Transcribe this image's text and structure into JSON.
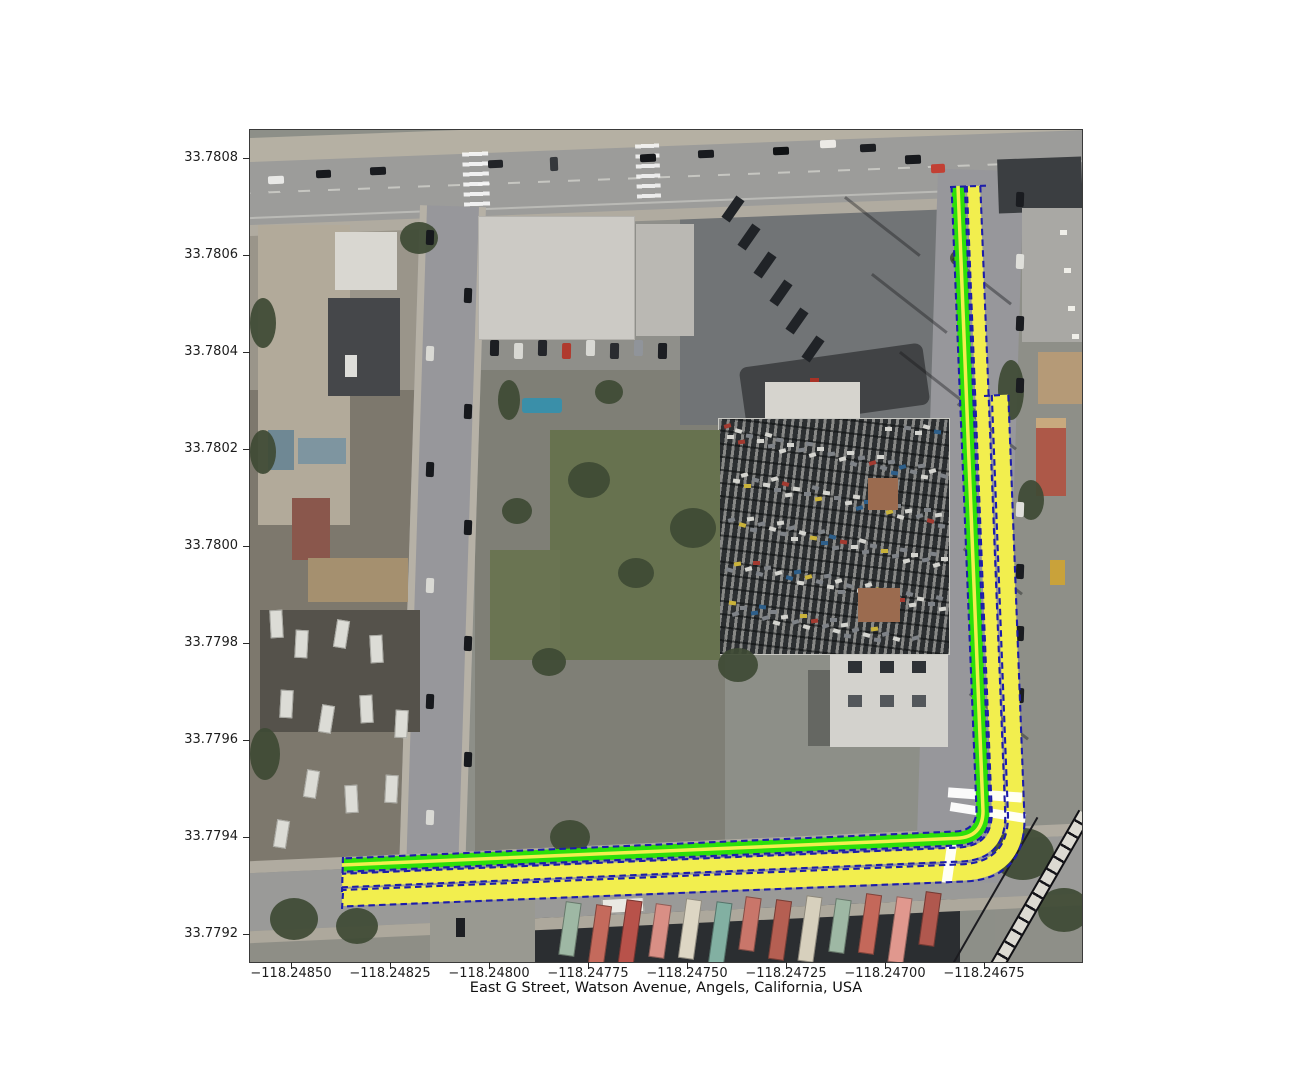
{
  "figure": {
    "title": "East G Street, Watson Avenue, Angels, California, USA"
  },
  "axes": {
    "x_ticks": [
      "−118.24850",
      "−118.24825",
      "−118.24800",
      "−118.24775",
      "−118.24750",
      "−118.24725",
      "−118.24700",
      "−118.24675"
    ],
    "y_ticks": [
      "33.7808",
      "33.7806",
      "33.7804",
      "33.7802",
      "33.7800",
      "33.7798",
      "33.7796",
      "33.7794",
      "33.7792"
    ]
  },
  "route": {
    "streets": [
      "East G Street",
      "Watson Avenue"
    ],
    "colors": {
      "highlight": "#f2ee4e",
      "secondary_highlight": "#2ce00a",
      "lane_edge": "#1d1daa",
      "crosswalk": "#ffffff"
    }
  },
  "basemap": {
    "type": "satellite-aerial",
    "railway_color": "#dcdad2",
    "vegetation_color": "#3e4a34",
    "container_palette": [
      "#9eb8a4",
      "#c46a5c",
      "#b8524a",
      "#d98f85",
      "#ddd6c4",
      "#82b0a2",
      "#c9766a",
      "#b55f52",
      "#d7d0bd",
      "#9eb8a4",
      "#c4685a",
      "#e0988e",
      "#b0584e"
    ]
  }
}
